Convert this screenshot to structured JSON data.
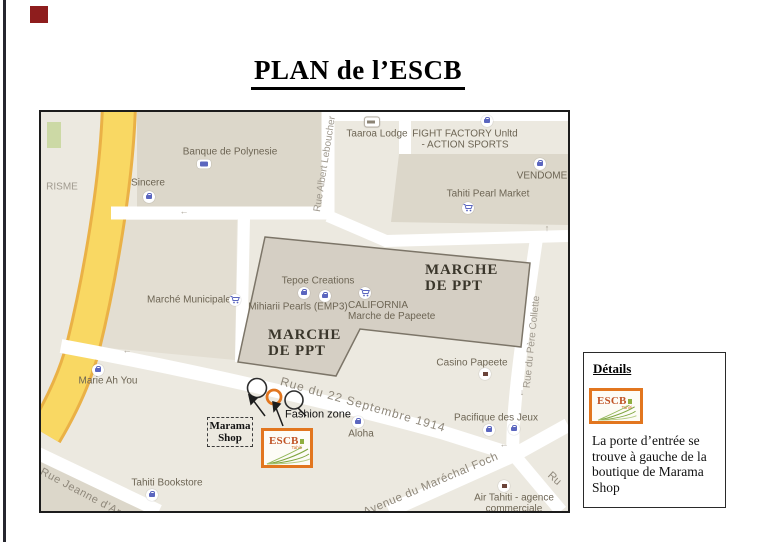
{
  "page": {
    "title": "PLAN de l’ESCB"
  },
  "map": {
    "streets": {
      "albert_leboucher": "Rue Albert Leboucher",
      "pere_collette": "Rue du Père Collette",
      "septembre_1914": "Rue du 22 Septembre 1914",
      "marechal_foch": "Avenue du Maréchal Foch",
      "jeanne_darc": "Rue Jeanne d’Arc",
      "ru_partial": "Ru"
    },
    "pois": {
      "risme": "RISME",
      "banque": "Banque de Polynesie",
      "sincere": "Sincere",
      "taaroa": "Taaroa Lodge",
      "fight_line1": "FIGHT FACTORY Unltd",
      "fight_line2": "- ACTION SPORTS",
      "vendome": "VENDOME",
      "pearl_market": "Tahiti Pearl Market",
      "tepoe": "Tepoe Creations",
      "mihiarii": "Mihiarii Pearls (EMP3)",
      "california_line1": "CALIFORNIA",
      "california_line2": "Marche de Papeete",
      "municipale": "Marché Municipale",
      "marie_ah_you": "Marie Ah You",
      "casino": "Casino Papeete",
      "pacifique": "Pacifique des Jeux",
      "aloha": "Aloha",
      "bookstore": "Tahiti Bookstore",
      "air_tahiti_line1": "Air Tahiti - agence",
      "air_tahiti_line2": "commerciale"
    },
    "marche_label": {
      "line1": "MARCHE",
      "line2": "DE PPT"
    },
    "annotations": {
      "marama_line1": "Marama",
      "marama_line2": "Shop",
      "fashion_zone": "Fashion zone"
    },
    "logo": {
      "name": "ESCB",
      "sub": "Tahiti"
    }
  },
  "details": {
    "title": "Détails",
    "logo": {
      "name": "ESCB",
      "sub": "Tahiti"
    },
    "body": "La porte d’entrée se trouve à gauche de la boutique de Marama Shop"
  },
  "colors": {
    "accent_orange": "#E2761F",
    "road_yellow": "#F9D863",
    "icon_blue": "#5B66BF",
    "block_grey": "#D5CFC4"
  }
}
